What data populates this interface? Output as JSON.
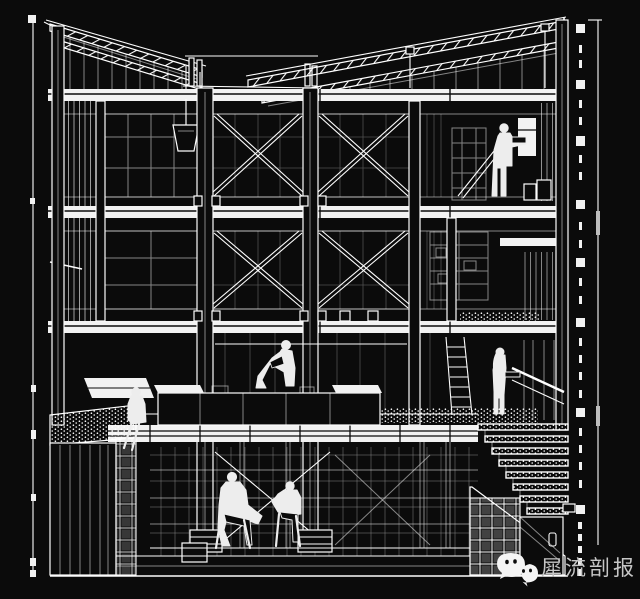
{
  "canvas": {
    "background": "#0b0b0b",
    "linework_color": "#ffffff",
    "secondary_line_color": "#9a9a9a"
  },
  "scene": {
    "alt": "Black-and-white sectional perspective drawing of a three-storey frame building with mezzanine, basement, stone stair and six human figures",
    "figure_count": 6,
    "storey_count": 3
  },
  "watermark": {
    "text": "犀流剖报",
    "icon": "wechat-logo-icon",
    "text_color": "#c6c6c6",
    "logo_color": "#f5f5f5"
  }
}
